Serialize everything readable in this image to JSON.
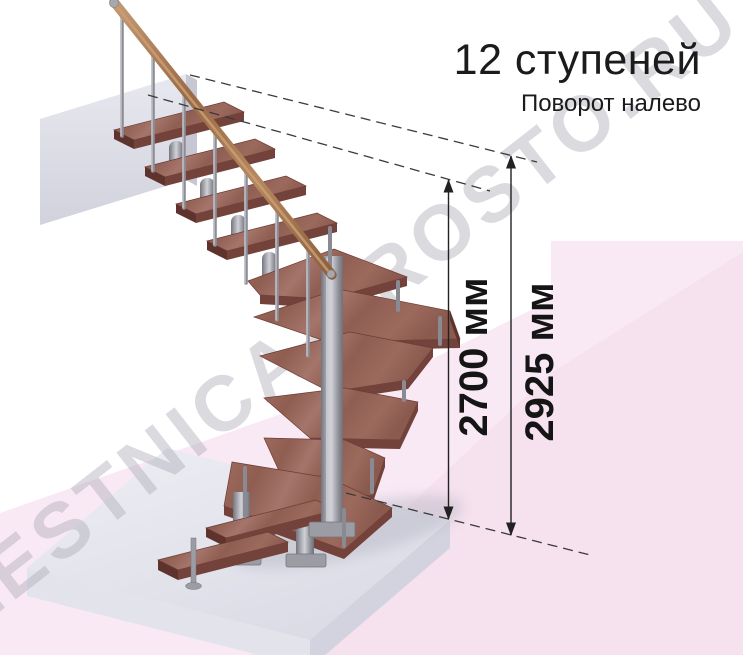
{
  "title": {
    "heading": "12 ступеней",
    "subheading": "Поворот налево"
  },
  "dimensions": {
    "line1": {
      "label": "2700 мм"
    },
    "line2": {
      "label": "2925 мм"
    }
  },
  "watermark": {
    "text": "LESTNICA-PROSTO.RU"
  },
  "colors": {
    "wood_tread": "#9a675c",
    "wood_edge": "#73423a",
    "handrail": "#a97a52",
    "metal": "#9b9ca4",
    "floor": "#e9e9f1",
    "background_pink": "#f9e9f4",
    "background_pink_deep": "#f4ddec",
    "dimension_text": "#151515",
    "watermark_gray": "#afafba"
  }
}
